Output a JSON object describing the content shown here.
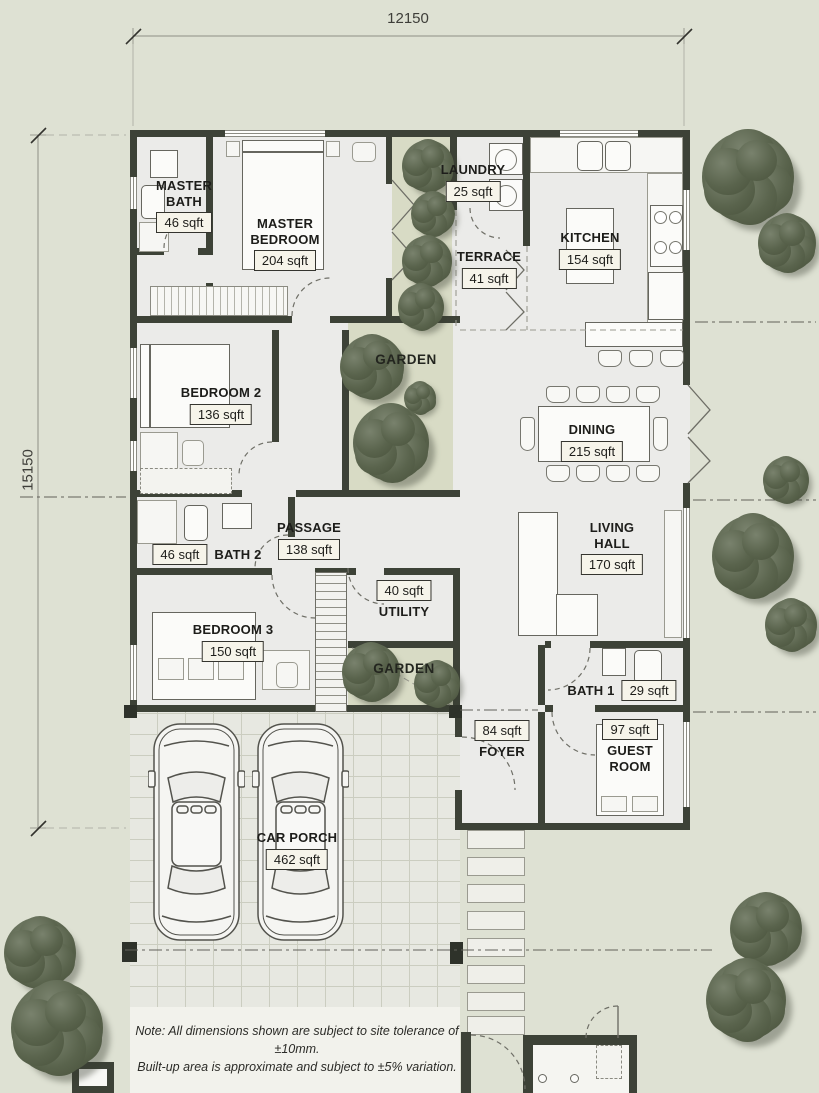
{
  "title": "Single-storey house floor plan",
  "dimensions": {
    "top": "12150",
    "left": "15150"
  },
  "rooms": [
    {
      "id": "master-bath",
      "name": "MASTER BATH",
      "area": "46 sqft"
    },
    {
      "id": "master-bedroom",
      "name": "MASTER BEDROOM",
      "area": "204 sqft"
    },
    {
      "id": "laundry",
      "name": "LAUNDRY",
      "area": "25 sqft"
    },
    {
      "id": "terrace",
      "name": "TERRACE",
      "area": "41 sqft"
    },
    {
      "id": "kitchen",
      "name": "KITCHEN",
      "area": "154 sqft"
    },
    {
      "id": "garden-1",
      "name": "GARDEN",
      "area": ""
    },
    {
      "id": "bedroom-2",
      "name": "BEDROOM 2",
      "area": "136 sqft"
    },
    {
      "id": "dining",
      "name": "DINING",
      "area": "215 sqft"
    },
    {
      "id": "bath-2",
      "name": "BATH 2",
      "area": "46 sqft"
    },
    {
      "id": "passage",
      "name": "PASSAGE",
      "area": "138 sqft"
    },
    {
      "id": "utility",
      "name": "UTILITY",
      "area": "40 sqft"
    },
    {
      "id": "living-hall",
      "name": "LIVING HALL",
      "area": "170 sqft"
    },
    {
      "id": "bedroom-3",
      "name": "BEDROOM 3",
      "area": "150 sqft"
    },
    {
      "id": "garden-2",
      "name": "GARDEN",
      "area": ""
    },
    {
      "id": "bath-1",
      "name": "BATH 1",
      "area": "29 sqft"
    },
    {
      "id": "foyer",
      "name": "FOYER",
      "area": "84 sqft"
    },
    {
      "id": "guest-room",
      "name": "GUEST ROOM",
      "area": "97 sqft"
    },
    {
      "id": "car-porch",
      "name": "CAR PORCH",
      "area": "462 sqft"
    }
  ],
  "note": {
    "line1": "Note: All dimensions shown are subject to site tolerance of ±10mm.",
    "line2": "Built-up area is approximate and subject to ±5% variation."
  },
  "colors": {
    "site_background": "#dee1d3",
    "floor": "#ebebe9",
    "wall": "#3d4237",
    "garden": "#d8dbc5",
    "tree": "#5a644d",
    "label_box": "#f6f4ea"
  },
  "site": {
    "trees": [
      [
        428,
        166,
        26
      ],
      [
        433,
        214,
        22
      ],
      [
        427,
        261,
        25
      ],
      [
        421,
        307,
        23
      ],
      [
        372,
        367,
        32
      ],
      [
        420,
        398,
        16
      ],
      [
        391,
        443,
        38
      ],
      [
        748,
        177,
        46
      ],
      [
        787,
        243,
        29
      ],
      [
        786,
        480,
        23
      ],
      [
        753,
        556,
        41
      ],
      [
        791,
        625,
        26
      ],
      [
        371,
        672,
        29
      ],
      [
        437,
        684,
        23
      ],
      [
        40,
        953,
        36
      ],
      [
        57,
        1028,
        46
      ],
      [
        766,
        929,
        36
      ],
      [
        746,
        1000,
        40
      ]
    ]
  }
}
